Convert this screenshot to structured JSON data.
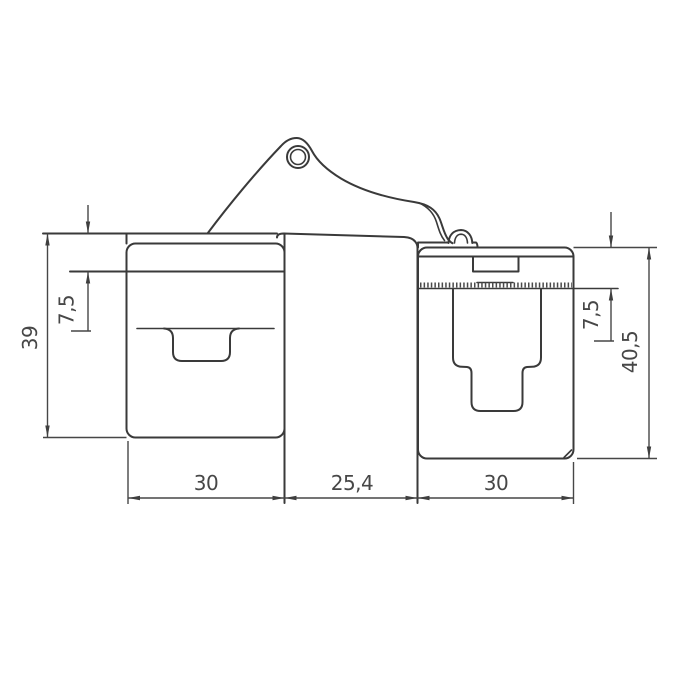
{
  "drawing": {
    "type": "technical-dimension-drawing",
    "subject": "concealed door hinge side cross-section",
    "background_color": "#ffffff",
    "object_line_color": "#3a3a3a",
    "dimension_line_color": "#474747",
    "dimensions": {
      "left_body_height": "39",
      "left_top_offset": "7,5",
      "right_top_offset": "7,5",
      "right_body_height": "40,5",
      "left_body_width": "30",
      "center_gap_width": "25,4",
      "right_body_width": "30"
    }
  }
}
